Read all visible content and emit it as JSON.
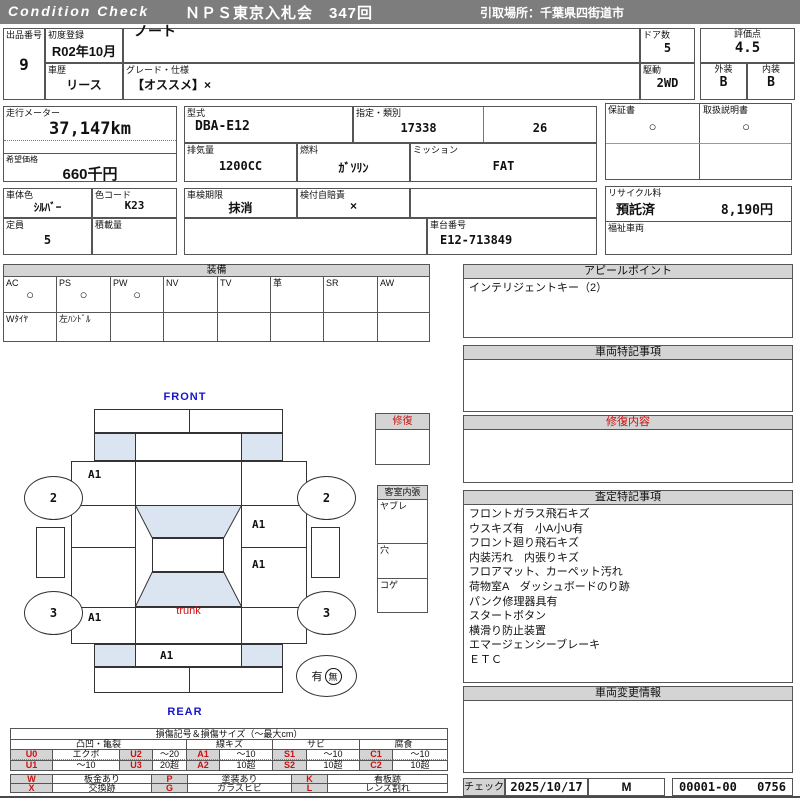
{
  "colors": {
    "header_bg": "#7d7d7d",
    "section_bg": "#d4d4d4",
    "glass_blue": "#dbe5f1",
    "label_blue": "#1515cc",
    "accent_red": "#cc1111"
  },
  "header": {
    "brand": "Condition  Check",
    "title": "ＮＰＳ東京入札会　347回",
    "pickup": "引取場所：千葉県四街道市"
  },
  "top": {
    "lot_label": "出品番号",
    "lot": "9",
    "first_reg_label": "初度登録",
    "first_reg": "R02年10月",
    "model_label": "車種名",
    "model": "ノート",
    "doors_label": "ドア数",
    "doors": "5",
    "score_label": "評価点",
    "score": "4.5",
    "history_label": "車歴",
    "history": "リース",
    "grade_label": "グレード・仕様",
    "grade": "【オススメ】×",
    "drive_label": "駆動",
    "drive": "2WD",
    "exterior_label": "外装",
    "exterior": "B",
    "interior_label": "内装",
    "interior": "B"
  },
  "meter": {
    "label": "走行メーター",
    "value": "37,147km",
    "price_label": "希望価格",
    "price": "660千円"
  },
  "spec": {
    "type_label": "型式",
    "type": "DBA-E12",
    "class_label": "指定・類別",
    "class1": "17338",
    "class2": "26",
    "displacement_label": "排気量",
    "displacement": "1200CC",
    "fuel_label": "燃料",
    "fuel": "ｶﾞｿﾘﾝ",
    "mission_label": "ミッション",
    "mission": "FAT"
  },
  "docs": {
    "warranty_label": "保証書",
    "warranty": "○",
    "manual_label": "取扱説明書",
    "manual": "○"
  },
  "body3": {
    "color_label": "車体色",
    "color": "ｼﾙﾊﾞｰ",
    "color_code_label": "色コード",
    "color_code": "K23",
    "capacity_label": "定員",
    "capacity": "5",
    "load_label": "積載量",
    "load": "",
    "inspection_label": "車検期限",
    "inspection": "抹消",
    "insurance_label": "検付自賠責",
    "insurance": "×",
    "chassis_label": "車台番号",
    "chassis": "E12-713849",
    "recycle_label": "リサイクル料",
    "recycle_status": "預託済",
    "recycle_fee": "8,190円",
    "welfare_label": "福祉車両",
    "welfare": ""
  },
  "equipment": {
    "title": "装備",
    "items": [
      {
        "label": "AC",
        "value": "○"
      },
      {
        "label": "PS",
        "value": "○"
      },
      {
        "label": "PW",
        "value": "○"
      },
      {
        "label": "NV",
        "value": ""
      },
      {
        "label": "TV",
        "value": ""
      },
      {
        "label": "革",
        "value": ""
      },
      {
        "label": "SR",
        "value": ""
      },
      {
        "label": "AW",
        "value": ""
      }
    ],
    "extras": [
      "Wﾀｲﾔ",
      "左ﾊﾝﾄﾞﾙ"
    ]
  },
  "diagram": {
    "front_label": "FRONT",
    "rear_label": "REAR",
    "trunk_label": "trunk",
    "wheel_front": "2",
    "wheel_rear": "3",
    "panel_marks": [
      "A1",
      "A1",
      "A1",
      "A1",
      "A1"
    ],
    "spare_has": "有",
    "spare_none": "無",
    "repair_box_label": "修復",
    "interior_box_label": "客室内張",
    "interior_rows": [
      "ヤブレ",
      "穴",
      "コゲ"
    ]
  },
  "panels": {
    "appeal": {
      "title": "アピールポイント",
      "line1": "インテリジェントキー（2）"
    },
    "notes": {
      "title": "車両特記事項"
    },
    "repair": {
      "title": "修復内容"
    },
    "assessment": {
      "title": "査定特記事項",
      "lines": [
        "フロントガラス飛石キズ",
        "ウスキズ有　小A小U有",
        "フロント廻り飛石キズ",
        "内装汚れ　内張りキズ",
        "フロアマット、カーペット汚れ",
        "荷物室A　ダッシュボードのり跡",
        "パンク修理器具有",
        "スタートボタン",
        "横滑り防止装置",
        "エマージェンシーブレーキ",
        "ＥＴＣ"
      ]
    },
    "changes": {
      "title": "車両変更情報"
    }
  },
  "check": {
    "label": "チェック",
    "date": "2025/10/17",
    "inspector": "M",
    "code": "00001-00",
    "number": "0756"
  },
  "legend": {
    "title": "損傷記号＆損傷サイズ（〜最大cm）",
    "groups": [
      "凸凹・亀裂",
      "線キズ",
      "サビ",
      "腐食"
    ],
    "rows": [
      [
        "U0",
        "エクボ",
        "U2",
        "〜20",
        "A1",
        "〜10",
        "S1",
        "〜10",
        "C1",
        "〜10"
      ],
      [
        "U1",
        "〜10",
        "U3",
        "20超",
        "A2",
        "10超",
        "S2",
        "10超",
        "C2",
        "10超"
      ]
    ],
    "rows2": [
      [
        "W",
        "板金あり",
        "P",
        "塗装あり",
        "K",
        "看板跡"
      ],
      [
        "X",
        "交換跡",
        "G",
        "ガラスヒビ",
        "L",
        "レンズ割れ"
      ]
    ]
  }
}
